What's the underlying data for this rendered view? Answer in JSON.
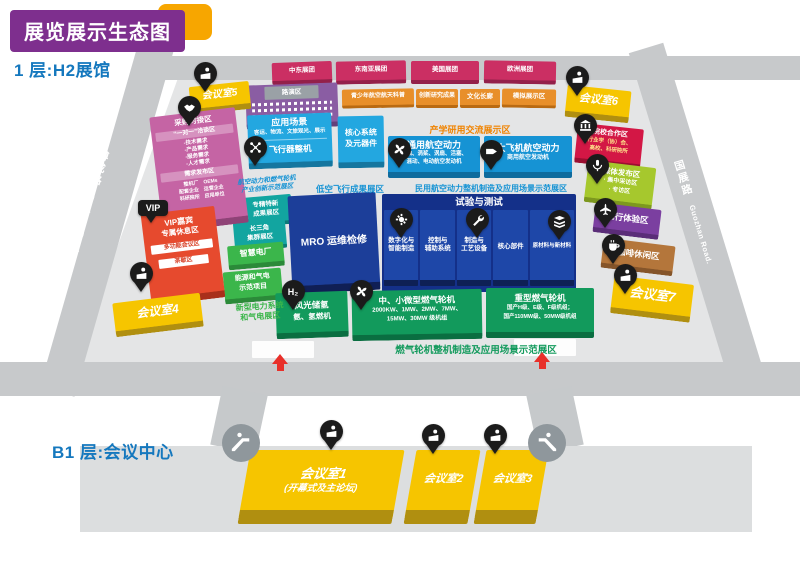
{
  "page": {
    "title": "展览展示生态图"
  },
  "colors": {
    "title_purple": "#7e2f8e",
    "accent_yellow": "#f7a600",
    "heading_blue": "#1578be",
    "road_gray": "#c7c9cb",
    "floor_gray": "#e4e5e6",
    "pink": "#cb2f63",
    "orange": "#e88f2a",
    "light_blue": "#23a7e0",
    "mid_blue": "#1693d4",
    "navy": "#1e47a8",
    "green": "#129a5c",
    "teal": "#12a5a0",
    "mid_green": "#3bb64b",
    "yellow": "#f6c500",
    "red": "#e64a2e",
    "crimson": "#d31745",
    "lime": "#a6c82d",
    "purple": "#7b3fa0",
    "brown": "#b4763b",
    "magenta": "#c564a4",
    "arrow_red": "#e8302a"
  },
  "floor1": {
    "label": "1 层:H2展馆",
    "roads": {
      "left_cn": "博成路",
      "left_en": "Bocheng Road.",
      "right_cn": "国展路",
      "right_en": "Guozhan Road."
    },
    "groups": [
      "中东展团",
      "东南亚展团",
      "美国展团",
      "欧洲展团"
    ],
    "roadshow": {
      "label": "路演区"
    },
    "edu_row": [
      "青少年航空航天科普",
      "创新研究成果",
      "文化长廊",
      "模拟展示区"
    ],
    "meeting5": "会议室5",
    "meeting6": "会议室6",
    "meeting7": "会议室7",
    "meeting4": "会议室4",
    "procurement": {
      "title": "采购对接区",
      "s1_title": "“一对一”洽谈区",
      "s1_items": "-技术需求\n-产品需求\n-服务需求\n-人才需求",
      "s2_title": "需求发布区",
      "s2_grid": "整机厂　OEMs\n配套企业　运营企业\n科研院所　应用单位"
    },
    "vip": {
      "pin": "VIP",
      "line1": "VIP嘉宾",
      "line2": "专属休息区",
      "band1": "多功能会议区",
      "band2": "茶歇区"
    },
    "application": {
      "title": "应用场景",
      "sub": "客运、物流、文旅观光、展示",
      "band": "飞行器整机"
    },
    "core": "核心系统\n及元器件",
    "industry_header": "产学研用交流展示区",
    "general_power": {
      "title": "通用航空动力",
      "sub": "涡轴、涡桨、涡扇、活塞、\n混动、电动航空发动机"
    },
    "big_aircraft": {
      "title": "大飞机航空动力",
      "sub": "商用航空发动机"
    },
    "innovation_header": "航空动力和燃气轮机\n产业创新示范展区",
    "low_altitude_header": "低空飞行成果展区",
    "civil_header": "民用航空动力整机制造及应用场景示范展区",
    "specialized": "专精特新\n成果展区",
    "delta": "长三角\n集群展区",
    "smart_plant": "智慧电厂",
    "energy_demo": "能源和气电\n示范项目",
    "power_header": "新型电力系统\n和气电展区",
    "mro": "MRO 运维检修",
    "test": {
      "title": "试验与测试",
      "col1": "数字化与\n智能制造",
      "col2": "控制与\n辅助系统",
      "col3": "制造与\n工艺设备",
      "col4": "核心部件",
      "col5": "原材料与新材料"
    },
    "hydrogen": {
      "pin": "H₂",
      "line1": "风光储氢",
      "line2": "氨、氢燃机"
    },
    "mid_small_gt": {
      "title": "中、小微型燃气轮机",
      "sub": "2000KW、1MW、2MW、7MW、\n15MW、30MW 级机组"
    },
    "heavy_gt": {
      "title": "重型燃气轮机",
      "sub": "国产H级、E级、F级机组；\n国产110MW级、50MW级机组"
    },
    "gt_header": "燃气轮机整机制造及应用场景示范展区",
    "institutions": {
      "title": "院校合作区",
      "sub": "行业学（协）会、\n高校、科研院所"
    },
    "media": {
      "title": "媒体发布区",
      "sub": "· 集中采访区\n· 专访区"
    },
    "flight_exp": "飞行体验区",
    "coffee": "咖啡休闲区"
  },
  "floorB1": {
    "label": "B1 层:会议中心",
    "room1": "会议室1",
    "room1_sub": "(开幕式及主论坛)",
    "room2": "会议室2",
    "room3": "会议室3"
  }
}
